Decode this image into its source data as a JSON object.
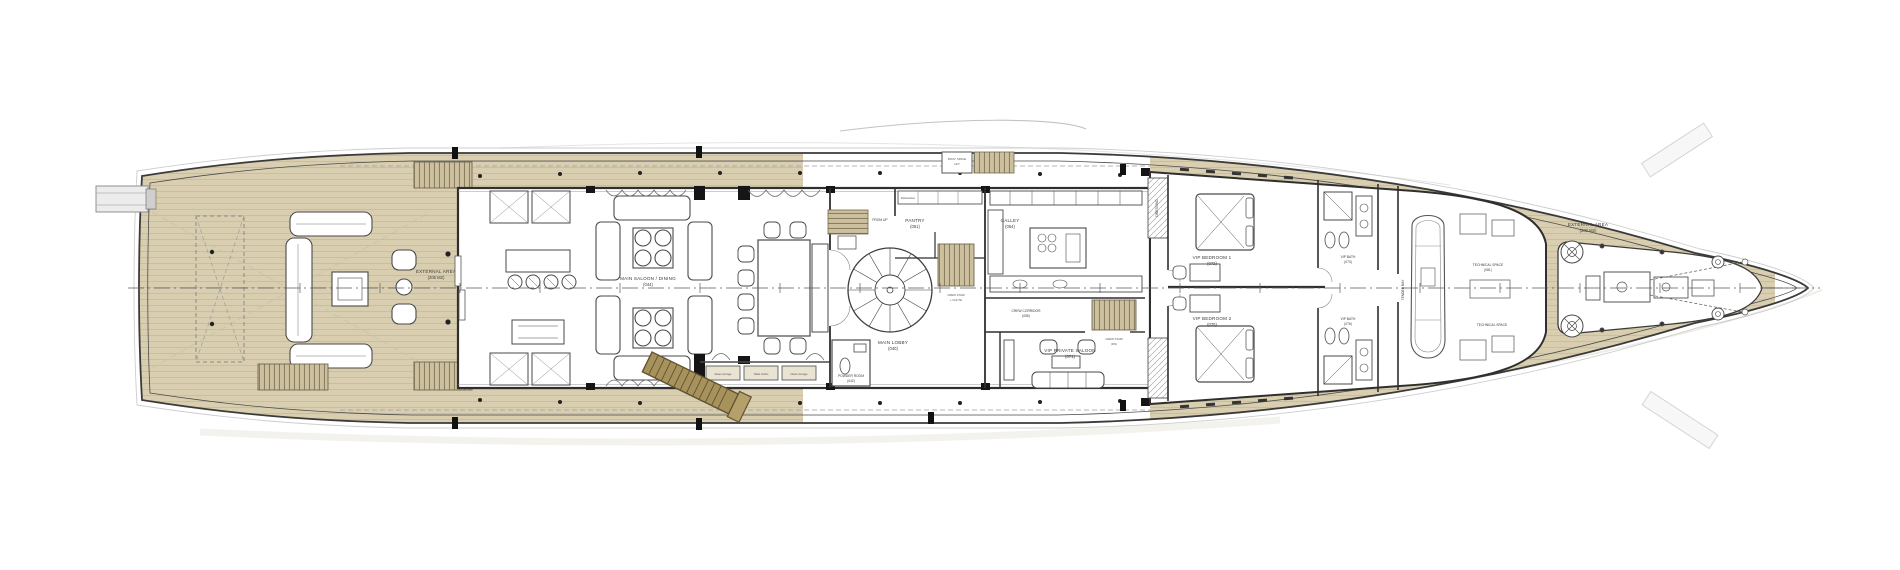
{
  "meta": {
    "drawing": "superyacht main deck general arrangement plan"
  },
  "colors": {
    "teak": "#d9cfb0",
    "teak_line": "#c3b38c",
    "ink": "#333333",
    "ink_light": "#8a8a8a",
    "ghost": "#c9c2ae",
    "ladder": "#a8925c",
    "white": "#ffffff"
  },
  "labels": {
    "aft_external": {
      "l1": "EXTERNAL AREA",
      "l2": "(206 M2)"
    },
    "main_saloon": {
      "l1": "MAIN SALOON / DINING",
      "l2": "(044)"
    },
    "powder_room": {
      "l1": "POWDER ROOM",
      "l2": "(042)"
    },
    "main_lobby": {
      "l1": "MAIN LOBBY",
      "l2": "(040)"
    },
    "from_up": {
      "l1": "FROM UP"
    },
    "pantry": {
      "l1": "PANTRY",
      "l2": "(051)"
    },
    "provisions_lift": {
      "l1": "PROV. SPACE",
      "l2": "LIFT"
    },
    "crew_stair_chute": {
      "l1": "CREW STAIR",
      "l2": "+ CHUTE"
    },
    "galley": {
      "l1": "GALLEY",
      "l2": "(054)"
    },
    "crew_corridor": {
      "l1": "CREW CORRIDOR",
      "l2": "(055)"
    },
    "crew_stair_dn": {
      "l1": "CREW STAIR",
      "l2": "(DN)"
    },
    "vip_saloon": {
      "l1": "VIP PRIVATE SALOON",
      "l2": "(071)"
    },
    "dressing": {
      "l1": "DRESSING"
    },
    "vip_bedroom_1": {
      "l1": "VIP BEDROOM 1",
      "l2": "(072)"
    },
    "vip_bath_1": {
      "l1": "VIP BATH",
      "l2": "(073)"
    },
    "vip_bedroom_2": {
      "l1": "VIP BEDROOM 2",
      "l2": "(075)"
    },
    "vip_bath_2": {
      "l1": "VIP BATH",
      "l2": "(076)"
    },
    "tender_bay": {
      "l1": "TENDER BAY"
    },
    "tech_space_1": {
      "l1": "TECHNICAL SPACE",
      "l2": "(081)"
    },
    "tech_space_2": {
      "l1": "TECHNICAL SPACE"
    },
    "fore_external": {
      "l1": "EXTERNAL AREA",
      "l2": "(200 M2)"
    },
    "storage_1": {
      "l1": "Glass storage"
    },
    "storage_2": {
      "l1": "Table cloths"
    },
    "storage_3": {
      "l1": "Glass storage"
    },
    "dishwasher": {
      "l1": "Dishwasher"
    }
  }
}
